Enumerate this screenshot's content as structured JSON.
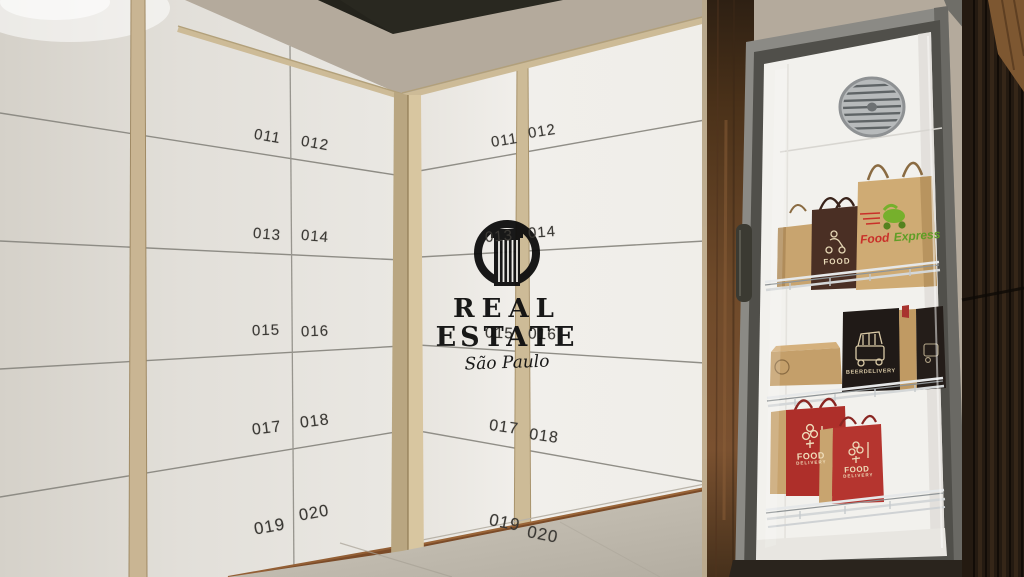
{
  "watermark": {
    "title_line1": "REAL",
    "title_line2": "ESTATE",
    "subtitle": "São Paulo"
  },
  "left_wall": {
    "lockers": [
      "011",
      "012",
      "013",
      "014",
      "015",
      "016",
      "017",
      "018",
      "019",
      "020"
    ]
  },
  "right_wall": {
    "lockers": [
      "011",
      "012",
      "013",
      "014",
      "015",
      "016",
      "017",
      "018",
      "019",
      "020"
    ]
  },
  "fridge": {
    "bags": {
      "food_express": {
        "word1": "Food",
        "word2": "Express"
      },
      "brown_bag": {
        "label": "FOOD"
      },
      "beer_bag": {
        "label": "BEERDELIVERY"
      },
      "red_bag_front": {
        "line1": "FOOD",
        "line2": "DELIVERY"
      },
      "red_bag_back": {
        "line1": "FOOD",
        "line2": "DELIVERY"
      }
    }
  },
  "colors": {
    "wall_beige": "#b4aa9c",
    "locker_white": "#ebe9e4",
    "plywood_trim": "#cdbb97",
    "walnut_wood": "#6b4628",
    "fridge_frame": "#8b8a85",
    "kraft": "#c8a46f",
    "delivery_red": "#ae2f2a",
    "express_green": "#6aa82e",
    "brand_black": "#0d0d0d"
  }
}
